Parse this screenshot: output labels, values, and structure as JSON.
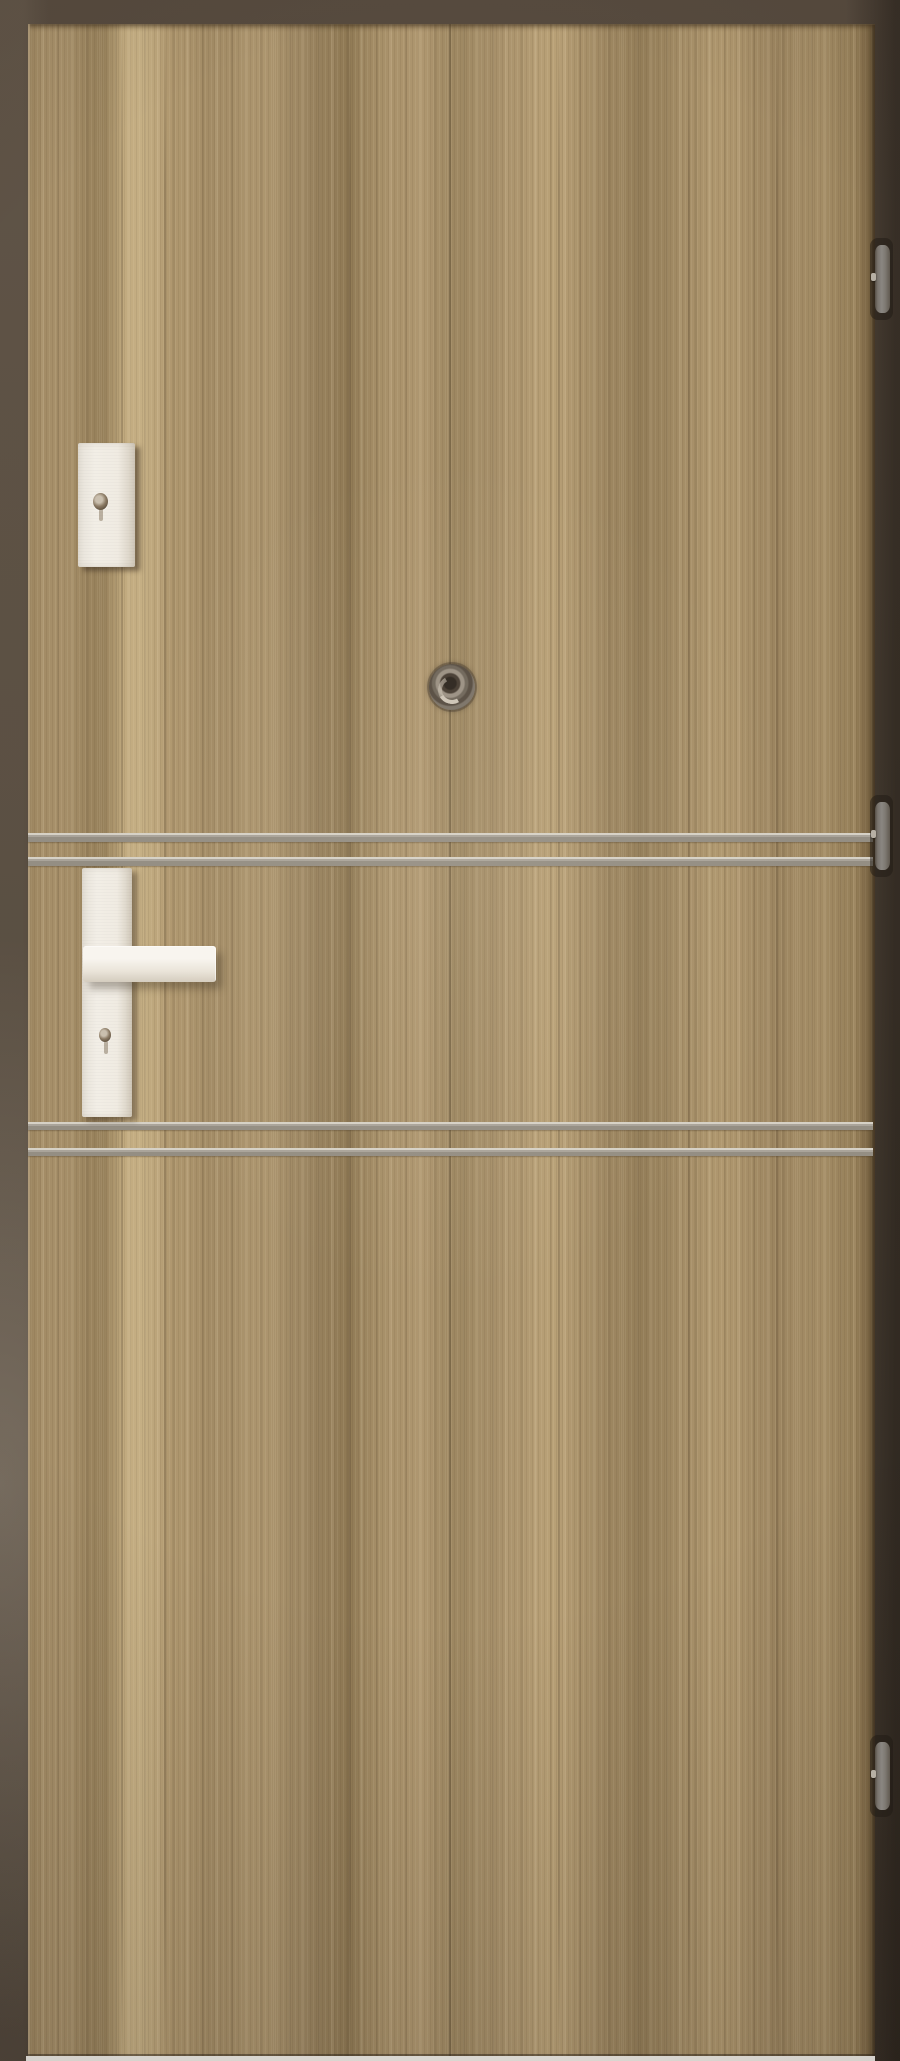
{
  "scene": {
    "type": "product-photograph",
    "subject": "Interior entrance door, vertical walnut-grain laminate, with aluminium inlay strips, white lever handle on long backplate, upper lock escutcheon, door viewer and three barrel hinges on the right edge",
    "visible_text": "none"
  },
  "palette": {
    "background_top": "#564a3e",
    "background_right": "#3e342a",
    "background_left_lower": "#6e6356",
    "wood_base": "#a8916b",
    "wood_dark": "#8e7852",
    "wood_light": "#c6b085",
    "inlay_strip": "#948e83",
    "inlay_strip_highlight": "#d6d1c6",
    "hardware_white": "#f2eee6",
    "hardware_shade": "#d4ccbe",
    "hinge_silver": "#f4f3f0",
    "peephole_dark": "#2c251e",
    "floor_strip": "#f2efe9"
  },
  "parts": {
    "wall": {
      "label": "wall background"
    },
    "door": {
      "label": "door leaf",
      "finish": "walnut laminate, vertical grain"
    },
    "escutcheon": {
      "label": "upper lock escutcheon with keyhole"
    },
    "escutcheon_keyhole": {
      "label": "cylinder keyhole"
    },
    "peephole": {
      "label": "door viewer (peephole)"
    },
    "handle_backplate": {
      "label": "handle backplate with keyhole"
    },
    "handle_keyhole": {
      "label": "handle keyhole"
    },
    "lever": {
      "label": "lever door handle"
    },
    "inlay_strips": {
      "label": "aluminium intarsia strips",
      "count": 4,
      "groups": 2,
      "items": [
        {
          "label": "inlay strip 1 (upper pair, top)"
        },
        {
          "label": "inlay strip 2 (upper pair, bottom)"
        },
        {
          "label": "inlay strip 3 (lower pair, top)"
        },
        {
          "label": "inlay strip 4 (lower pair, bottom)"
        }
      ]
    },
    "hinges": {
      "label": "barrel hinges",
      "count": 3,
      "items": [
        {
          "label": "top hinge"
        },
        {
          "label": "middle hinge"
        },
        {
          "label": "bottom hinge"
        }
      ]
    },
    "floor": {
      "label": "floor strip below door"
    }
  }
}
